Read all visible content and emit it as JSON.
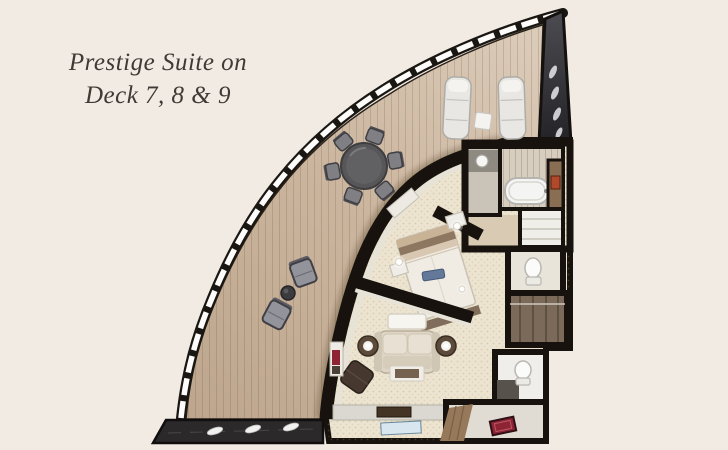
{
  "title": {
    "line1": "Prestige Suite on",
    "line2": "Deck 7, 8 & 9"
  },
  "colors": {
    "bg": "#f1ebe4",
    "title-ink": "#3f3a35",
    "deck-light": "#dccdbb",
    "deck-mid": "#cbb59e",
    "deck-dark": "#bda68d",
    "wall-ink": "#17120e",
    "carpet": "#ece4d0",
    "glass-dark": "#2a2a2f",
    "walkway-marble": "#2c292a",
    "doormat-red": "#8e2433",
    "art-orange": "#b0482a",
    "tv-screen-blue": "#9fc0d4",
    "wood-cabinet": "#8a6e53"
  },
  "floorplan": {
    "elements": [
      "balcony-deck",
      "balcony-railing",
      "glass-wall",
      "dining-table",
      "dining-chairs",
      "sun-loungers",
      "lounger-side-table",
      "lounge-chairs",
      "balcony-coffee-table",
      "bedroom-bed",
      "nightstands",
      "bedside-lamps",
      "bathroom-bathtub",
      "bathroom-sink",
      "towel-closet",
      "wall-art",
      "wc-toilet",
      "wardrobe",
      "guest-toilet",
      "living-sofa",
      "sofa-table",
      "side-tables",
      "ottoman",
      "coffee-table",
      "tv-console",
      "tv-screen",
      "bookshelf",
      "entrance-hall",
      "entrance-doormat",
      "promenade-walkway"
    ]
  }
}
